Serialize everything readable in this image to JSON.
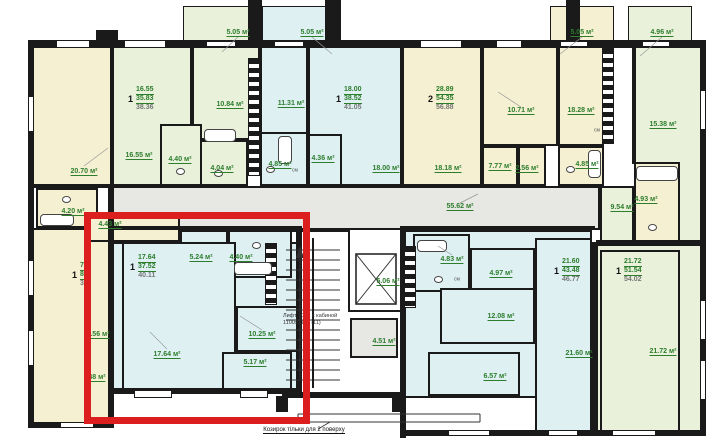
{
  "plan": {
    "palette": {
      "y": "#f5f0d2",
      "g": "#e9f1db",
      "c": "#def0f2",
      "gr": "#e7e7e4",
      "w": "#ffffff"
    },
    "wall_color": "#1a1a1a",
    "label_color": "#2c7d2c",
    "red_box": {
      "x": 84,
      "y": 212,
      "w": 226,
      "h": 212,
      "color": "#dc1e1e"
    },
    "rooms": [
      {
        "name": "balcony-5-05-a",
        "x": 183,
        "y": 6,
        "w": 66,
        "h": 36,
        "fill": "g",
        "thin": true
      },
      {
        "name": "balcony-5-05-b",
        "x": 262,
        "y": 6,
        "w": 72,
        "h": 36,
        "fill": "c",
        "thin": true
      },
      {
        "name": "balcony-5-05-c",
        "x": 550,
        "y": 6,
        "w": 64,
        "h": 36,
        "fill": "y",
        "thin": true
      },
      {
        "name": "balcony-4-96",
        "x": 628,
        "y": 6,
        "w": 64,
        "h": 36,
        "fill": "g",
        "thin": true
      },
      {
        "name": "room-20-70",
        "x": 32,
        "y": 44,
        "w": 80,
        "h": 142,
        "fill": "y"
      },
      {
        "name": "room-16-55",
        "x": 112,
        "y": 44,
        "w": 80,
        "h": 142,
        "fill": "g"
      },
      {
        "name": "room-10-84",
        "x": 192,
        "y": 44,
        "w": 68,
        "h": 96,
        "fill": "g"
      },
      {
        "name": "room-4-40-a",
        "x": 160,
        "y": 124,
        "w": 42,
        "h": 62,
        "fill": "g"
      },
      {
        "name": "room-4-04",
        "x": 200,
        "y": 140,
        "w": 48,
        "h": 46,
        "fill": "g"
      },
      {
        "name": "room-11-31",
        "x": 260,
        "y": 44,
        "w": 48,
        "h": 90,
        "fill": "c"
      },
      {
        "name": "room-4-85-a",
        "x": 260,
        "y": 132,
        "w": 48,
        "h": 54,
        "fill": "c"
      },
      {
        "name": "room-18-00",
        "x": 308,
        "y": 44,
        "w": 94,
        "h": 142,
        "fill": "c"
      },
      {
        "name": "room-4-36",
        "x": 308,
        "y": 134,
        "w": 34,
        "h": 52,
        "fill": "c"
      },
      {
        "name": "room-18-18",
        "x": 402,
        "y": 44,
        "w": 80,
        "h": 142,
        "fill": "y"
      },
      {
        "name": "room-10-71",
        "x": 482,
        "y": 44,
        "w": 76,
        "h": 102,
        "fill": "y"
      },
      {
        "name": "room-7-77",
        "x": 482,
        "y": 146,
        "w": 36,
        "h": 40,
        "fill": "y"
      },
      {
        "name": "room-2-56",
        "x": 518,
        "y": 146,
        "w": 28,
        "h": 40,
        "fill": "y"
      },
      {
        "name": "room-18-28",
        "x": 558,
        "y": 44,
        "w": 46,
        "h": 102,
        "fill": "y"
      },
      {
        "name": "room-4-85-b",
        "x": 558,
        "y": 146,
        "w": 46,
        "h": 40,
        "fill": "y"
      },
      {
        "name": "room-15-38",
        "x": 634,
        "y": 44,
        "w": 72,
        "h": 198,
        "fill": "g"
      },
      {
        "name": "room-9-54",
        "x": 600,
        "y": 186,
        "w": 34,
        "h": 58,
        "fill": "g"
      },
      {
        "name": "room-4-93",
        "x": 634,
        "y": 162,
        "w": 46,
        "h": 80,
        "fill": "y"
      },
      {
        "name": "corridor-55-62",
        "x": 112,
        "y": 186,
        "w": 488,
        "h": 44,
        "fill": "gr"
      },
      {
        "name": "left-apartment",
        "x": 32,
        "y": 228,
        "w": 80,
        "h": 196,
        "fill": "y"
      },
      {
        "name": "room-4-20",
        "x": 36,
        "y": 188,
        "w": 62,
        "h": 40,
        "fill": "y"
      },
      {
        "name": "room-4-43",
        "x": 84,
        "y": 212,
        "w": 96,
        "h": 30,
        "fill": "y"
      },
      {
        "name": "stair-hall",
        "x": 282,
        "y": 230,
        "w": 120,
        "h": 164,
        "fill": "w"
      },
      {
        "name": "apartment-f-base",
        "x": 112,
        "y": 242,
        "w": 186,
        "h": 150,
        "fill": "c"
      },
      {
        "name": "room-5-24",
        "x": 180,
        "y": 230,
        "w": 48,
        "h": 44,
        "fill": "c"
      },
      {
        "name": "room-4-40-b",
        "x": 228,
        "y": 230,
        "w": 64,
        "h": 48,
        "fill": "c"
      },
      {
        "name": "room-17-64",
        "x": 122,
        "y": 242,
        "w": 114,
        "h": 150,
        "fill": "c"
      },
      {
        "name": "room-10-25",
        "x": 236,
        "y": 306,
        "w": 62,
        "h": 46,
        "fill": "c"
      },
      {
        "name": "room-5-17",
        "x": 222,
        "y": 352,
        "w": 70,
        "h": 40,
        "fill": "c"
      },
      {
        "name": "elevator-shaft",
        "x": 348,
        "y": 228,
        "w": 54,
        "h": 84,
        "fill": "w"
      },
      {
        "name": "room-4-51",
        "x": 350,
        "y": 318,
        "w": 48,
        "h": 40,
        "fill": "gr"
      },
      {
        "name": "apartment-g-base",
        "x": 403,
        "y": 230,
        "w": 189,
        "h": 168,
        "fill": "c"
      },
      {
        "name": "room-4-83",
        "x": 413,
        "y": 234,
        "w": 57,
        "h": 58,
        "fill": "c"
      },
      {
        "name": "room-4-97",
        "x": 470,
        "y": 248,
        "w": 65,
        "h": 52,
        "fill": "c"
      },
      {
        "name": "room-12-08",
        "x": 440,
        "y": 288,
        "w": 95,
        "h": 56,
        "fill": "c"
      },
      {
        "name": "room-6-57",
        "x": 428,
        "y": 352,
        "w": 92,
        "h": 44,
        "fill": "c"
      },
      {
        "name": "room-21-60",
        "x": 535,
        "y": 238,
        "w": 57,
        "h": 197,
        "fill": "c"
      },
      {
        "name": "apartment-h-base",
        "x": 596,
        "y": 244,
        "w": 110,
        "h": 191,
        "fill": "g"
      },
      {
        "name": "room-21-72",
        "x": 600,
        "y": 250,
        "w": 80,
        "h": 185,
        "fill": "g"
      }
    ],
    "walls": [
      {
        "x": 28,
        "y": 40,
        "w": 678,
        "h": 8
      },
      {
        "x": 28,
        "y": 40,
        "w": 6,
        "h": 388
      },
      {
        "x": 700,
        "y": 40,
        "w": 6,
        "h": 396
      },
      {
        "x": 28,
        "y": 422,
        "w": 86,
        "h": 6
      },
      {
        "x": 108,
        "y": 184,
        "w": 6,
        "h": 244
      },
      {
        "x": 110,
        "y": 388,
        "w": 192,
        "h": 6
      },
      {
        "x": 296,
        "y": 226,
        "w": 6,
        "h": 170
      },
      {
        "x": 400,
        "y": 226,
        "w": 6,
        "h": 212
      },
      {
        "x": 282,
        "y": 392,
        "w": 124,
        "h": 6
      },
      {
        "x": 403,
        "y": 430,
        "w": 303,
        "h": 6
      },
      {
        "x": 592,
        "y": 242,
        "w": 6,
        "h": 194
      },
      {
        "x": 596,
        "y": 240,
        "w": 110,
        "h": 5
      },
      {
        "x": 632,
        "y": 44,
        "w": 4,
        "h": 120
      },
      {
        "x": 112,
        "y": 226,
        "w": 186,
        "h": 4
      },
      {
        "x": 403,
        "y": 226,
        "w": 192,
        "h": 4
      },
      {
        "x": 28,
        "y": 184,
        "w": 84,
        "h": 4
      },
      {
        "x": 248,
        "y": 0,
        "w": 14,
        "h": 46
      },
      {
        "x": 325,
        "y": 0,
        "w": 16,
        "h": 46
      },
      {
        "x": 566,
        "y": 0,
        "w": 14,
        "h": 46
      },
      {
        "x": 96,
        "y": 30,
        "w": 22,
        "h": 12
      },
      {
        "x": 276,
        "y": 396,
        "w": 12,
        "h": 16
      },
      {
        "x": 392,
        "y": 396,
        "w": 12,
        "h": 16
      }
    ],
    "vents": [
      {
        "x": 248,
        "y": 58,
        "w": 12,
        "h": 118
      },
      {
        "x": 602,
        "y": 48,
        "w": 12,
        "h": 96
      },
      {
        "x": 404,
        "y": 246,
        "w": 12,
        "h": 62
      },
      {
        "x": 265,
        "y": 243,
        "w": 12,
        "h": 62
      }
    ],
    "windows": [
      {
        "x": 56,
        "y": 40,
        "w": 34,
        "h": 8
      },
      {
        "x": 124,
        "y": 40,
        "w": 42,
        "h": 8
      },
      {
        "x": 206,
        "y": 41,
        "w": 30,
        "h": 6
      },
      {
        "x": 274,
        "y": 41,
        "w": 30,
        "h": 6
      },
      {
        "x": 420,
        "y": 40,
        "w": 42,
        "h": 8
      },
      {
        "x": 496,
        "y": 40,
        "w": 26,
        "h": 8
      },
      {
        "x": 560,
        "y": 41,
        "w": 28,
        "h": 6
      },
      {
        "x": 642,
        "y": 41,
        "w": 28,
        "h": 6
      },
      {
        "x": 134,
        "y": 390,
        "w": 38,
        "h": 8
      },
      {
        "x": 240,
        "y": 390,
        "w": 28,
        "h": 8
      },
      {
        "x": 60,
        "y": 422,
        "w": 34,
        "h": 6
      },
      {
        "x": 448,
        "y": 430,
        "w": 42,
        "h": 6
      },
      {
        "x": 548,
        "y": 430,
        "w": 30,
        "h": 6
      },
      {
        "x": 612,
        "y": 430,
        "w": 44,
        "h": 6
      },
      {
        "x": 28,
        "y": 96,
        "w": 6,
        "h": 36
      },
      {
        "x": 28,
        "y": 260,
        "w": 6,
        "h": 36
      },
      {
        "x": 28,
        "y": 330,
        "w": 6,
        "h": 36
      },
      {
        "x": 700,
        "y": 90,
        "w": 6,
        "h": 40
      },
      {
        "x": 700,
        "y": 300,
        "w": 6,
        "h": 40
      },
      {
        "x": 700,
        "y": 360,
        "w": 6,
        "h": 40
      }
    ],
    "fixtures": [
      {
        "type": "tub",
        "x": 204,
        "y": 129,
        "w": 32,
        "h": 13
      },
      {
        "type": "tub",
        "x": 278,
        "y": 136,
        "w": 14,
        "h": 28
      },
      {
        "type": "tub",
        "x": 40,
        "y": 214,
        "w": 34,
        "h": 12
      },
      {
        "type": "tub",
        "x": 234,
        "y": 262,
        "w": 38,
        "h": 13
      },
      {
        "type": "tub",
        "x": 417,
        "y": 240,
        "w": 30,
        "h": 12
      },
      {
        "type": "tub",
        "x": 636,
        "y": 166,
        "w": 42,
        "h": 15
      },
      {
        "type": "tub",
        "x": 588,
        "y": 150,
        "w": 13,
        "h": 28
      },
      {
        "type": "wc",
        "x": 176,
        "y": 168,
        "w": 9,
        "h": 7
      },
      {
        "type": "wc",
        "x": 266,
        "y": 166,
        "w": 9,
        "h": 7
      },
      {
        "type": "wc",
        "x": 62,
        "y": 196,
        "w": 9,
        "h": 7
      },
      {
        "type": "wc",
        "x": 252,
        "y": 242,
        "w": 9,
        "h": 7
      },
      {
        "type": "wc",
        "x": 434,
        "y": 276,
        "w": 9,
        "h": 7
      },
      {
        "type": "wc",
        "x": 648,
        "y": 224,
        "w": 9,
        "h": 7
      },
      {
        "type": "wc",
        "x": 566,
        "y": 166,
        "w": 9,
        "h": 7
      },
      {
        "type": "wc",
        "x": 214,
        "y": 170,
        "w": 9,
        "h": 7
      }
    ],
    "labels": [
      {
        "text": "5.05 м²",
        "x": 238,
        "y": 33
      },
      {
        "text": "5.05 м²",
        "x": 312,
        "y": 33
      },
      {
        "text": "5.05 м²",
        "x": 582,
        "y": 33
      },
      {
        "text": "4.96 м²",
        "x": 662,
        "y": 33
      },
      {
        "text": "20.70 м²",
        "x": 84,
        "y": 172
      },
      {
        "text": "16.55 м²",
        "x": 139,
        "y": 156
      },
      {
        "text": "10.84 м²",
        "x": 230,
        "y": 105
      },
      {
        "text": "4.40 м²",
        "x": 180,
        "y": 160
      },
      {
        "text": "4.04 м²",
        "x": 222,
        "y": 169
      },
      {
        "text": "11.31 м²",
        "x": 291,
        "y": 104
      },
      {
        "text": "4.85 м²",
        "x": 280,
        "y": 165
      },
      {
        "text": "4.36 м²",
        "x": 323,
        "y": 159
      },
      {
        "text": "18.00 м²",
        "x": 386,
        "y": 169
      },
      {
        "text": "18.18 м²",
        "x": 448,
        "y": 169
      },
      {
        "text": "10.71 м²",
        "x": 521,
        "y": 111
      },
      {
        "text": "7.77 м²",
        "x": 500,
        "y": 167
      },
      {
        "text": "2.56 м²",
        "x": 527,
        "y": 169
      },
      {
        "text": "18.28 м²",
        "x": 581,
        "y": 111
      },
      {
        "text": "4.85 м²",
        "x": 587,
        "y": 165
      },
      {
        "text": "15.38 м²",
        "x": 663,
        "y": 125
      },
      {
        "text": "9.54 м²",
        "x": 622,
        "y": 208
      },
      {
        "text": "4.93 м²",
        "x": 646,
        "y": 200
      },
      {
        "text": "55.62 м²",
        "x": 460,
        "y": 207
      },
      {
        "text": "4.20 м²",
        "x": 73,
        "y": 212
      },
      {
        "text": "4.43 м²",
        "x": 110,
        "y": 225
      },
      {
        "text": "4.56 м²",
        "x": 98,
        "y": 335
      },
      {
        "text": "48 м²",
        "x": 97,
        "y": 378
      },
      {
        "text": "5.24 м²",
        "x": 201,
        "y": 258
      },
      {
        "text": "4.40 м²",
        "x": 241,
        "y": 258
      },
      {
        "text": "17.64 м²",
        "x": 167,
        "y": 355
      },
      {
        "text": "10.25 м²",
        "x": 262,
        "y": 335
      },
      {
        "text": "5.17 м²",
        "x": 255,
        "y": 363
      },
      {
        "text": "5.06 м²",
        "x": 388,
        "y": 282
      },
      {
        "text": "4.51 м²",
        "x": 384,
        "y": 342
      },
      {
        "text": "4.83 м²",
        "x": 452,
        "y": 260
      },
      {
        "text": "4.97 м²",
        "x": 501,
        "y": 274
      },
      {
        "text": "12.08 м²",
        "x": 501,
        "y": 317
      },
      {
        "text": "6.57 м²",
        "x": 495,
        "y": 377
      },
      {
        "text": "21.60 м²",
        "x": 579,
        "y": 354
      },
      {
        "text": "21.72 м²",
        "x": 663,
        "y": 352
      },
      {
        "text": "см",
        "x": 295,
        "y": 171,
        "cls": "sm"
      },
      {
        "text": "см",
        "x": 597,
        "y": 131,
        "cls": "sm"
      },
      {
        "text": "см",
        "x": 457,
        "y": 280,
        "cls": "sm"
      }
    ],
    "apartments": [
      {
        "name": "apartment-a-label",
        "num": "1",
        "lines": [
          "16.55",
          "35.83",
          "38.36"
        ],
        "x": 128,
        "y": 86
      },
      {
        "name": "apartment-b-label",
        "num": "1",
        "lines": [
          "18.00",
          "38.52",
          "41.05"
        ],
        "x": 336,
        "y": 86
      },
      {
        "name": "apartment-c-label",
        "num": "2",
        "lines": [
          "28.89",
          "54.35",
          "56.88"
        ],
        "x": 428,
        "y": 86
      },
      {
        "name": "apartment-e-label",
        "num": "1",
        "lines": [
          "70",
          "89",
          "33"
        ],
        "x": 72,
        "y": 262
      },
      {
        "name": "apartment-f-label",
        "num": "1",
        "lines": [
          "17.64",
          "37.52",
          "40.11"
        ],
        "x": 130,
        "y": 254
      },
      {
        "name": "apartment-g-label",
        "num": "1",
        "lines": [
          "21.60",
          "43.48",
          "46.77"
        ],
        "x": 554,
        "y": 258
      },
      {
        "name": "apartment-h-label",
        "num": "1",
        "lines": [
          "21.72",
          "51.54",
          "54.02"
        ],
        "x": 616,
        "y": 258
      }
    ],
    "notes": {
      "lift_line1": "Лифт 1000 с кабиной",
      "lift_line2": "1100х2100 (11)",
      "canopy": "Козирок тільки для 2 поверху"
    }
  }
}
